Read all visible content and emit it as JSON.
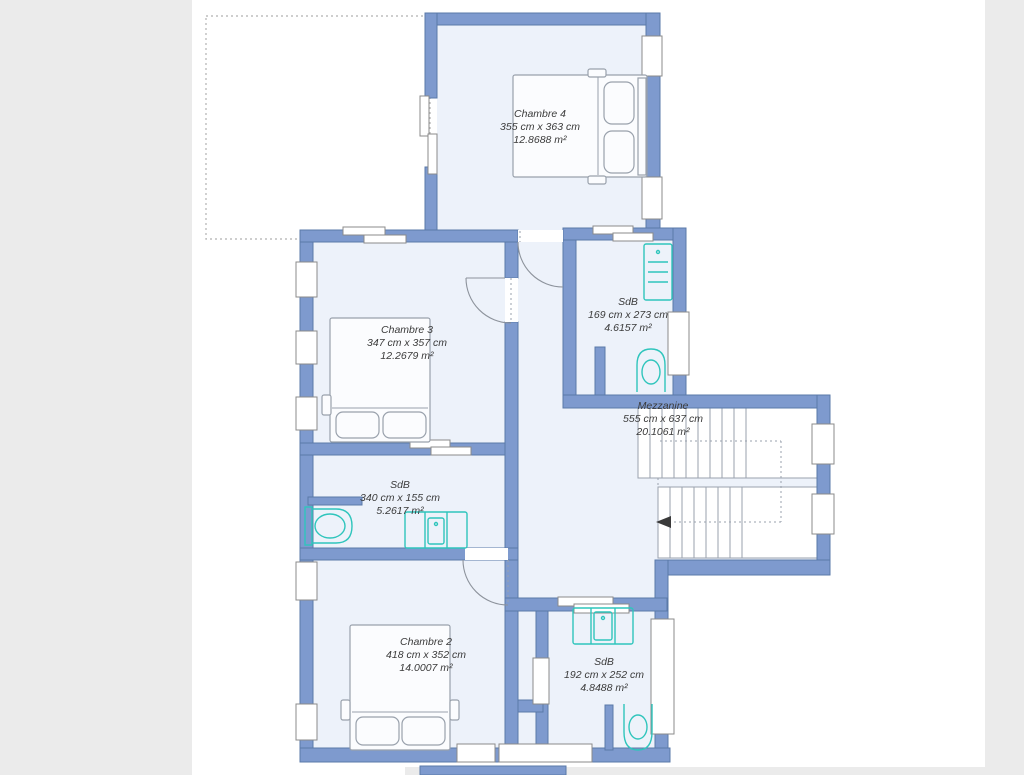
{
  "plan": {
    "rooms": [
      {
        "id": "chambre-4",
        "name": "Chambre 4",
        "dimensions": "355 cm x 363 cm",
        "area": "12.8688 m²"
      },
      {
        "id": "chambre-3",
        "name": "Chambre 3",
        "dimensions": "347 cm x 357 cm",
        "area": "12.2679 m²"
      },
      {
        "id": "sdb-top",
        "name": "SdB",
        "dimensions": "169 cm x 273 cm",
        "area": "4.6157 m²"
      },
      {
        "id": "mezzanine",
        "name": "Mezzanine",
        "dimensions": "555 cm x 637 cm",
        "area": "20.1061 m²"
      },
      {
        "id": "sdb-middle",
        "name": "SdB",
        "dimensions": "340 cm x 155 cm",
        "area": "5.2617 m²"
      },
      {
        "id": "chambre-2",
        "name": "Chambre 2",
        "dimensions": "418 cm x 352 cm",
        "area": "14.0007 m²"
      },
      {
        "id": "sdb-bottom",
        "name": "SdB",
        "dimensions": "192 cm x 252 cm",
        "area": "4.8488 m²"
      }
    ],
    "colors": {
      "wall": "#7e9ace",
      "wall_stroke": "#5a79a8",
      "floor": "#edf2fa",
      "fixture_teal": "#2fc5bc",
      "furniture_stroke": "#99a1ac",
      "app_background": "#ebebeb",
      "canvas": "#ffffff",
      "dashed_outline": "#bdbdbd",
      "label_text": "#3b3b3b"
    }
  }
}
